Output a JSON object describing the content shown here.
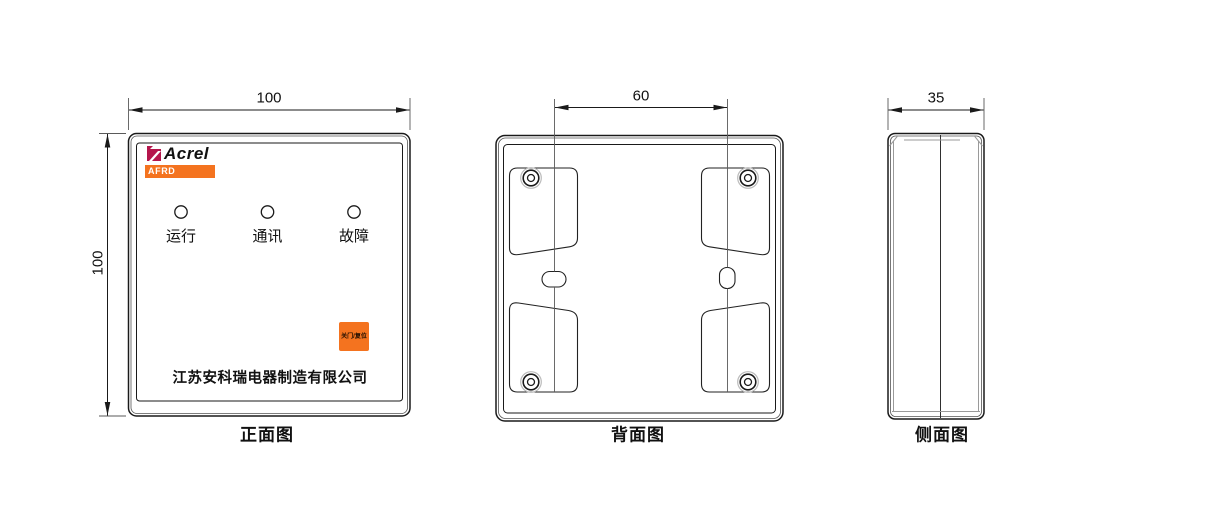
{
  "views": {
    "front": {
      "caption": "正面图",
      "brand": "Acrel",
      "model": "AFRD",
      "leds": [
        {
          "label": "运行"
        },
        {
          "label": "通讯"
        },
        {
          "label": "故障"
        }
      ],
      "button_label": "关门/复位",
      "company": "江苏安科瑞电器制造有限公司",
      "width_dim": "100",
      "height_dim": "100"
    },
    "back": {
      "caption": "背面图",
      "hole_spacing_dim": "60"
    },
    "side": {
      "caption": "侧面图",
      "depth_dim": "35"
    }
  },
  "colors": {
    "accent_orange": "#F4731F",
    "brand_red": "#B5164C",
    "line_dark": "#1A1A1A"
  },
  "icons": {
    "acrel_logo_mark": "flag-mark",
    "screw": "concentric-circles",
    "led_indicator": "circle-outline",
    "mounting_slot": "capsule-slot"
  }
}
